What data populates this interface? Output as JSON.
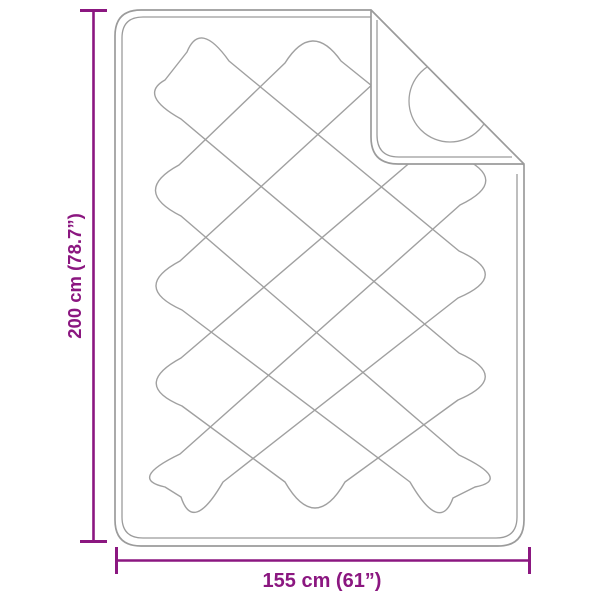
{
  "diagram": {
    "title": "blanket-dimension-diagram",
    "height_dimension": {
      "label": "200 cm (78.7”)"
    },
    "width_dimension": {
      "label": "155 cm (61”)"
    }
  },
  "colors": {
    "dimension_accent": "#8B1780",
    "blanket_outline": "#9B9B9B",
    "stitch_lines": "#A0A0A0",
    "background": "#FFFFFF"
  }
}
